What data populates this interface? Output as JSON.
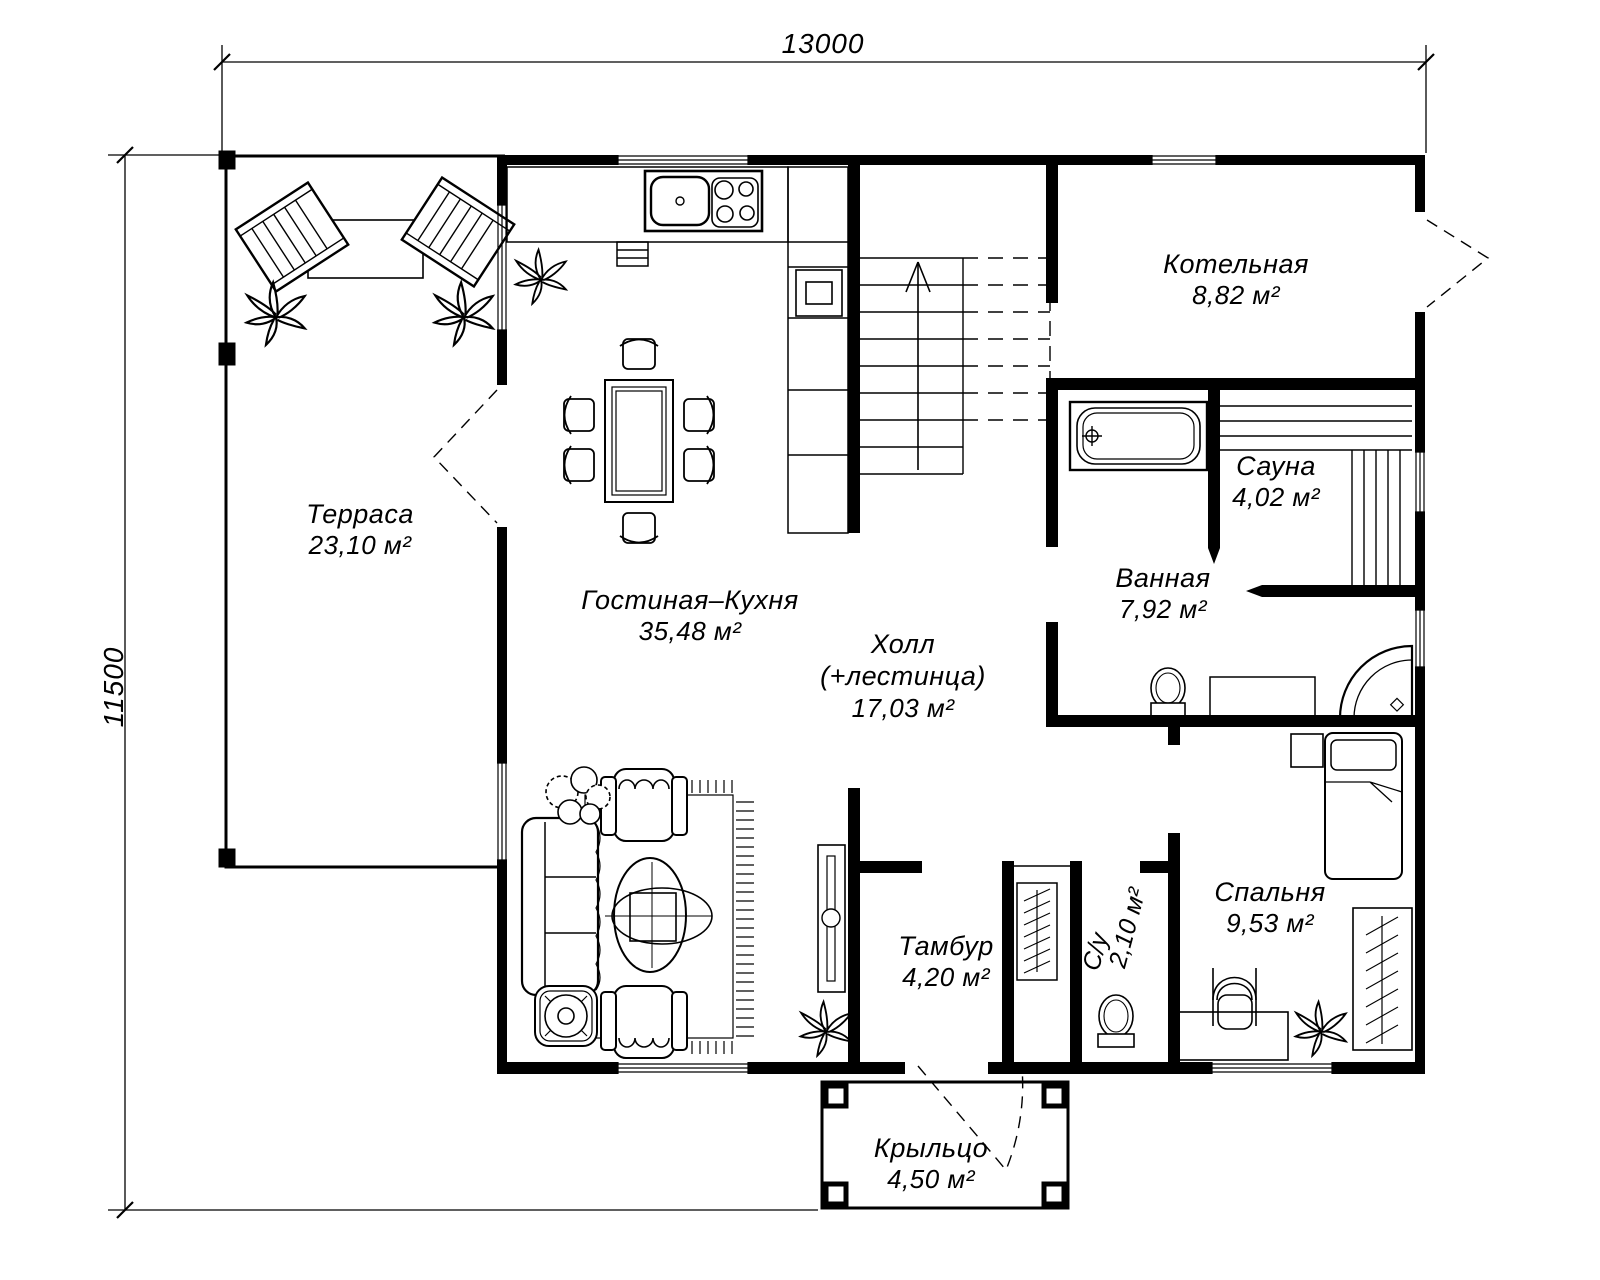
{
  "drawing": {
    "type": "floor-plan",
    "ink_color": "#000000",
    "background_color": "#ffffff"
  },
  "dimensions": {
    "width_label": "13000",
    "height_label": "11500"
  },
  "rooms": [
    {
      "name": "Терраса",
      "area": "23,10 м²"
    },
    {
      "name": "Гостиная–Кухня",
      "area": "35,48 м²"
    },
    {
      "name": "Холл",
      "name2": "(+лестинца)",
      "area": "17,03 м²"
    },
    {
      "name": "Котельная",
      "area": "8,82 м²"
    },
    {
      "name": "Сауна",
      "area": "4,02 м²"
    },
    {
      "name": "Ванная",
      "area": "7,92 м²"
    },
    {
      "name": "Тамбур",
      "area": "4,20 м²"
    },
    {
      "name": "С/у",
      "area": "2,10 м²"
    },
    {
      "name": "Спальня",
      "area": "9,53 м²"
    },
    {
      "name": "Крыльцо",
      "area": "4,50 м²"
    }
  ]
}
